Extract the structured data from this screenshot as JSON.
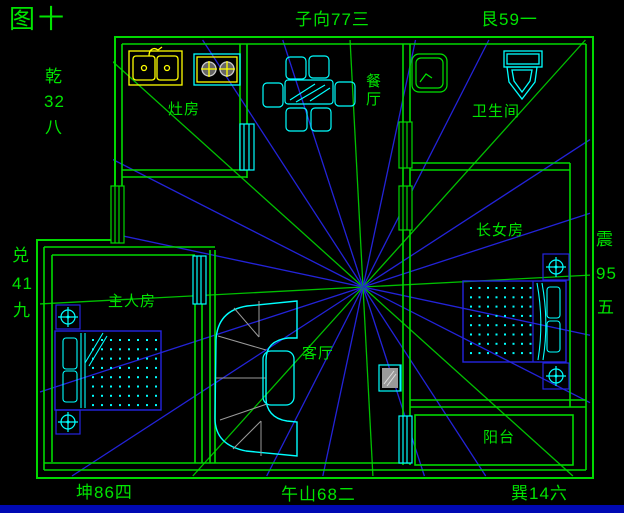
{
  "title": "图十",
  "compass_labels": {
    "top_center": "子向77三",
    "top_right": "艮59一",
    "bottom_left": "坤86四",
    "bottom_center": "午山68二",
    "bottom_right": "巽14六",
    "left_upper": [
      "乾",
      "32",
      "八"
    ],
    "left_lower": [
      "兑",
      "41",
      "九"
    ],
    "right_side": [
      "震",
      "95",
      "五"
    ]
  },
  "rooms": {
    "kitchen": "灶房",
    "dining": "餐厅",
    "bathroom": "卫生间",
    "daughter": "长女房",
    "master": "主人房",
    "living": "客厅",
    "balcony": "阳台"
  },
  "colors": {
    "background": "#000000",
    "wall_green": "#00d900",
    "text_green": "#00e400",
    "cyan": "#00ffff",
    "yellow": "#ffff00",
    "furniture_blue": "#2424e0",
    "sofa_gray": "#9a9a9a",
    "taskbar_blue": "#0009b4"
  },
  "compass": {
    "center_x": 363,
    "center_y": 287,
    "count": 24,
    "start_deg": -3,
    "step_deg": 15,
    "green_every": 3,
    "bounds": [
      40,
      40,
      590,
      476
    ],
    "blue": "#2323d8",
    "green": "#00c000"
  },
  "dot_grids": [
    {
      "x": 92,
      "y": 339,
      "cols": 8,
      "rows": 8,
      "dx": 9,
      "dy": 9.3
    },
    {
      "x": 470,
      "y": 287,
      "cols": 8,
      "rows": 8,
      "dx": 8.5,
      "dy": 9.3
    }
  ]
}
